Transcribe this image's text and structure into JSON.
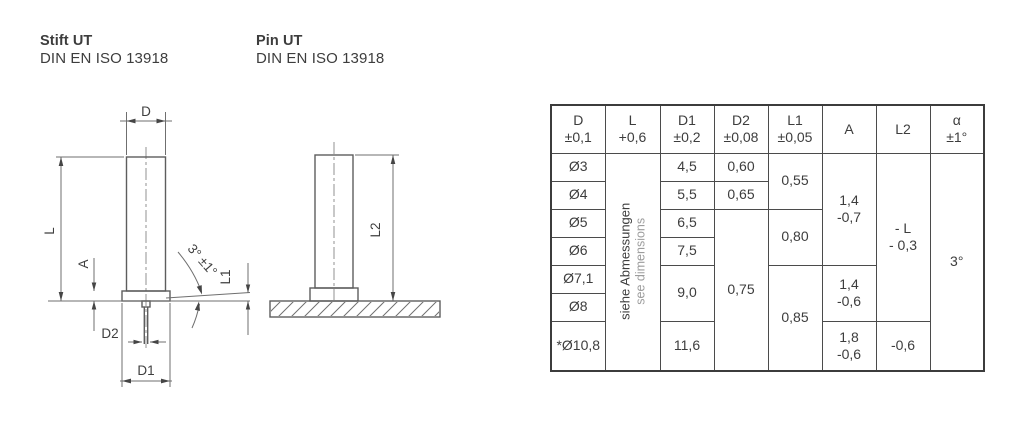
{
  "colors": {
    "background": "#ffffff",
    "text": "#3d3d3d",
    "muted_text": "#9c9c9c",
    "table_border": "#3c3c3c",
    "drawing_line": "#5d5d5d"
  },
  "header_blocks": [
    {
      "title": "Stift UT",
      "standard": "DIN EN ISO 13918"
    },
    {
      "title": "Pin UT",
      "standard": "DIN EN ISO 13918"
    }
  ],
  "drawings": {
    "front_view": {
      "dim_labels": {
        "d": "D",
        "l": "L",
        "a": "A",
        "d2": "D2",
        "d1": "D1",
        "l1": "L1",
        "angle": "3° ±1°"
      }
    },
    "welded_view": {
      "dim_labels": {
        "l2": "L2"
      }
    }
  },
  "table": {
    "headers": [
      {
        "symbol": "D",
        "tolerance": "±0,1"
      },
      {
        "symbol": "L",
        "tolerance": "+0,6"
      },
      {
        "symbol": "D1",
        "tolerance": "±0,2"
      },
      {
        "symbol": "D2",
        "tolerance": "±0,08"
      },
      {
        "symbol": "L1",
        "tolerance": "±0,05"
      },
      {
        "symbol": "A",
        "tolerance": ""
      },
      {
        "symbol": "L2",
        "tolerance": ""
      },
      {
        "symbol": "α",
        "tolerance": "±1°"
      }
    ],
    "l_column_note": {
      "de": "siehe Abmessungen",
      "en": "see dimensions"
    },
    "d_values": [
      "Ø3",
      "Ø4",
      "Ø5",
      "Ø6",
      "Ø7,1",
      "Ø8",
      "*Ø10,8"
    ],
    "d1_values": [
      "4,5",
      "5,5",
      "6,5",
      "7,5",
      "9,0",
      "11,6"
    ],
    "d2_values": [
      "0,60",
      "0,65",
      "0,75"
    ],
    "l1_values": [
      "0,55",
      "0,80",
      "0,85"
    ],
    "a_values": [
      {
        "line1": "1,4",
        "line2": "-0,7"
      },
      {
        "line1": "1,4",
        "line2": "-0,6"
      },
      {
        "line1": "1,8",
        "line2": "-0,6"
      }
    ],
    "l2_values": [
      {
        "line1": "- L",
        "line2": "- 0,3"
      },
      {
        "line1": "-0,6",
        "line2": ""
      }
    ],
    "alpha_value": "3°"
  }
}
